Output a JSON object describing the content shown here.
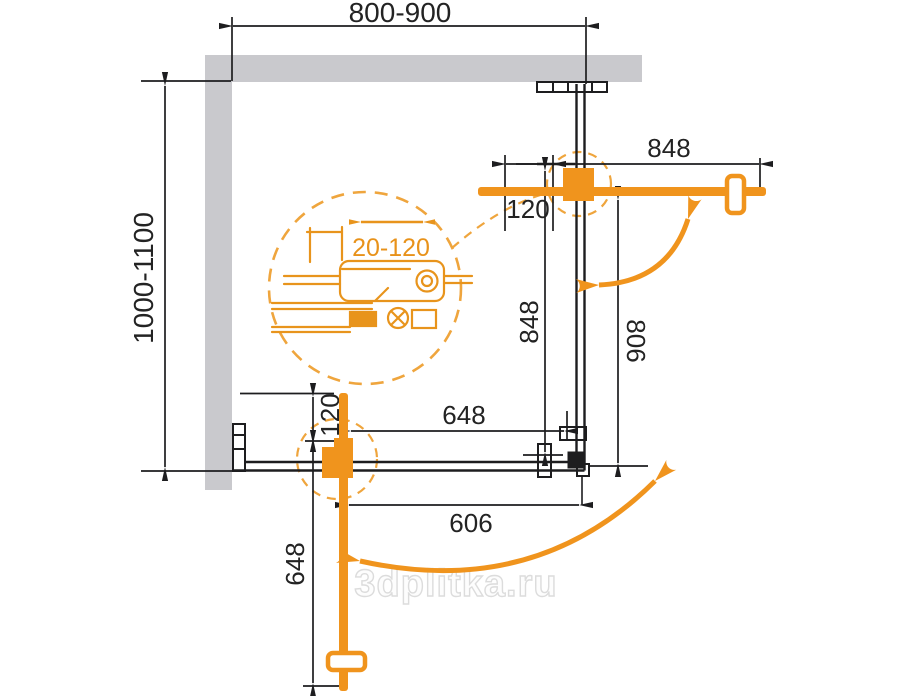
{
  "drawing": {
    "type": "shower-enclosure-plan-scheme",
    "dims": {
      "top_width": "800-900",
      "left_depth": "1000-1100",
      "door_top_length": "848",
      "door_top_pivot_offset": "120",
      "right_panel_height": "848",
      "door_top_swing_clear": "806",
      "bottom_panel_width": "648",
      "door_bottom_pivot_offset": "120",
      "door_bottom_length": "648",
      "door_bottom_swing_clear": "606",
      "hinge_adjustment_range": "20-120"
    },
    "colors": {
      "accent_orange": "#F0941D",
      "detail_orange": "#E8941C",
      "dashed_orange": "#EFA53D",
      "wall_gray": "#C9C9CD",
      "line_black": "#1D1D1F",
      "watermark_gray": "#DCDCDC"
    }
  },
  "watermark": {
    "text": "3dplitka.ru"
  }
}
